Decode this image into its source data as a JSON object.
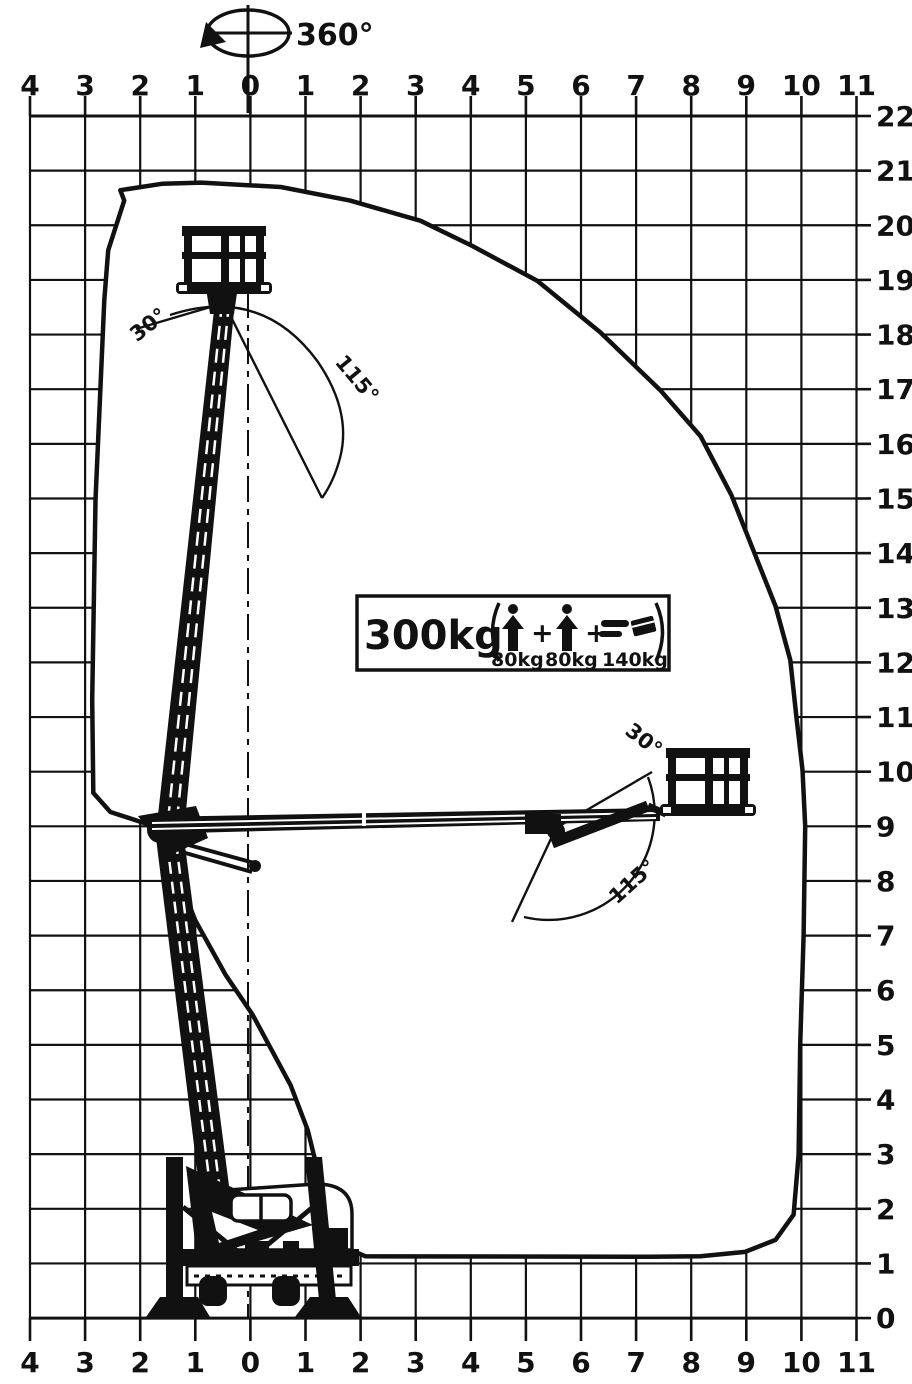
{
  "diagram": {
    "rotation_label": "360°",
    "angles": {
      "up": "30°",
      "range": "115°"
    },
    "load": {
      "total": "300kg",
      "operator1": "80kg",
      "operator2": "80kg",
      "equipment": "140kg",
      "plus": "+"
    },
    "axes": {
      "top": [
        "4",
        "3",
        "2",
        "1",
        "0",
        "1",
        "2",
        "3",
        "4",
        "5",
        "6",
        "7",
        "8",
        "9",
        "10",
        "11"
      ],
      "bottom": [
        "4",
        "3",
        "2",
        "1",
        "0",
        "1",
        "2",
        "3",
        "4",
        "5",
        "6",
        "7",
        "8",
        "9",
        "10",
        "11"
      ],
      "right": [
        "22",
        "21",
        "20",
        "19",
        "18",
        "17",
        "16",
        "15",
        "14",
        "13",
        "12",
        "11",
        "10",
        "9",
        "8",
        "7",
        "6",
        "5",
        "4",
        "3",
        "2",
        "1",
        "0"
      ]
    },
    "colors": {
      "ink": "#111111",
      "paper": "#ffffff"
    },
    "envelope_points_m": [
      [
        -2.37,
        20.64
      ],
      [
        -1.6,
        20.76
      ],
      [
        -0.9,
        20.78
      ],
      [
        0.54,
        20.7
      ],
      [
        1.8,
        20.45
      ],
      [
        3.08,
        20.08
      ],
      [
        4.02,
        19.62
      ],
      [
        5.2,
        18.98
      ],
      [
        6.34,
        18.04
      ],
      [
        7.43,
        16.98
      ],
      [
        8.16,
        16.14
      ],
      [
        8.72,
        15.06
      ],
      [
        9.52,
        13.03
      ],
      [
        9.79,
        12.04
      ],
      [
        9.9,
        11.0
      ],
      [
        10.01,
        10.03
      ],
      [
        10.06,
        9.0
      ],
      [
        10.03,
        7.0
      ],
      [
        9.97,
        5.0
      ],
      [
        9.94,
        2.98
      ],
      [
        9.85,
        1.89
      ],
      [
        9.52,
        1.43
      ],
      [
        8.97,
        1.21
      ],
      [
        8.16,
        1.13
      ],
      [
        7.25,
        1.12
      ],
      [
        2.08,
        1.13
      ],
      [
        1.59,
        1.34
      ],
      [
        1.3,
        2.34
      ],
      [
        1.03,
        3.44
      ],
      [
        0.72,
        4.26
      ],
      [
        0.03,
        5.55
      ],
      [
        -0.46,
        6.28
      ],
      [
        -1.01,
        7.28
      ],
      [
        -1.55,
        8.66
      ],
      [
        -1.82,
        9.02
      ],
      [
        -2.55,
        9.26
      ],
      [
        -2.86,
        9.61
      ],
      [
        -2.88,
        11.31
      ],
      [
        -2.82,
        14.97
      ],
      [
        -2.66,
        18.63
      ],
      [
        -2.59,
        19.54
      ],
      [
        -2.3,
        20.45
      ]
    ]
  }
}
